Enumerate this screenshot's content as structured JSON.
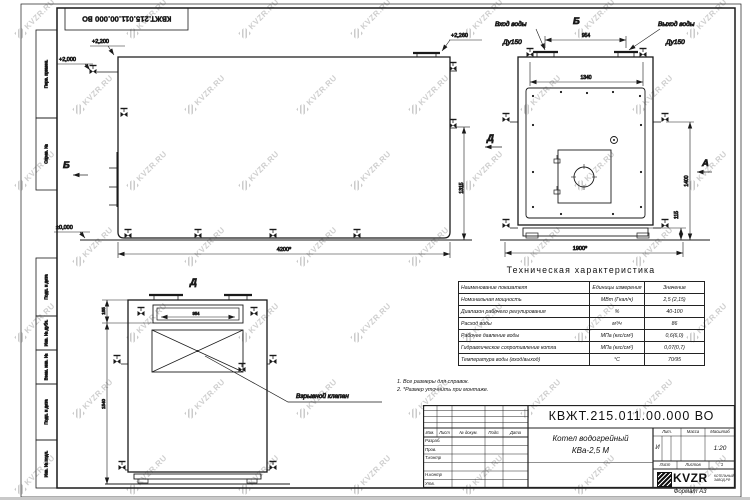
{
  "doc": {
    "number": "КВЖТ.215.011.00.000 ВО",
    "name_line1": "Котел водогрейный",
    "name_line2": "КВа-2,5 М",
    "lit": "И",
    "scale": "1:20",
    "sheets_count": "1",
    "format": "Формат А3",
    "logo": "KVZR",
    "logo_sub1": "КОТЕЛЬНЫЙ",
    "logo_sub2": "ЗАВОД.РФ"
  },
  "watermark": {
    "text": "KVZR.RU"
  },
  "frame": {
    "side_labels": [
      "Перв. примен.",
      "Справ. №",
      "Подп. и дата",
      "Инв. № дубл.",
      "Взам. инв. №",
      "Подп. и дата",
      "Инв. № подл."
    ]
  },
  "titleblock": {
    "header_cols": [
      "Изм.",
      "Лист",
      "№ докум.",
      "Подп.",
      "Дата"
    ],
    "rows": [
      "Разраб.",
      "Пров.",
      "Т.контр",
      "",
      "Н.контр",
      "Утв."
    ],
    "lit_label": "Лит.",
    "mass_label": "Масса",
    "scale_label": "Масштаб",
    "sheet_label": "Лист",
    "sheets_label": "Листов"
  },
  "notes": [
    "1. Все размеры для справок.",
    "2. *Размер уточнить при монтаже."
  ],
  "table": {
    "title": "Техническая характеристика",
    "headers": [
      "Наименование показателя",
      "Единицы измерения",
      "Значение"
    ],
    "rows": [
      [
        "Номинальная мощность",
        "МВт (Гкал/ч)",
        "2,5 (2,15)"
      ],
      [
        "Диапазон рабочего регулирования",
        "%",
        "40-100"
      ],
      [
        "Расход воды",
        "м³/ч",
        "86"
      ],
      [
        "Рабочее давление воды",
        "МПа (кгс/см²)",
        "0,6(6,0)"
      ],
      [
        "Гидравлическое сопротивление котла",
        "МПа (кгс/см²)",
        "0,07(0,7)"
      ],
      [
        "Температура воды (вход/выход)",
        "°С",
        "70/95"
      ]
    ]
  },
  "views": {
    "main": {
      "elev2200": "+2,200",
      "elev2000": "+2,000",
      "elev2260": "+2,260",
      "elev0": "±0,000",
      "label_b": "Б",
      "label_d": "Д",
      "dim1315": "1315",
      "dim4200": "4200*"
    },
    "rear": {
      "title": "Б",
      "label_a": "А",
      "inlet": "Вход воды",
      "inlet_dn": "Ду150",
      "outlet": "Выход воды",
      "outlet_dn": "Ду150",
      "dim954": "954",
      "dim1340": "1340",
      "dim1400": "1400",
      "dim115": "115",
      "dim1900": "1900*"
    },
    "front": {
      "title": "Д",
      "dim185": "185",
      "dim954": "954",
      "dim1540": "1540",
      "callout": "Взрывной клапан"
    }
  }
}
